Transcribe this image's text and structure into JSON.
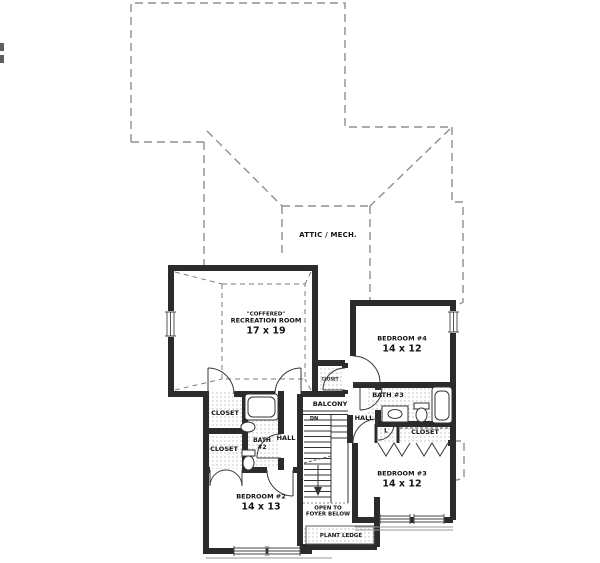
{
  "plan": {
    "type": "second-floor-plan",
    "colors": {
      "wall": "#2b2b2b",
      "roof_dash": "#8f8f8f",
      "text": "#141414",
      "bg": "#ffffff"
    },
    "rooms": {
      "attic": {
        "label": "ATTIC / MECH."
      },
      "recreation": {
        "note": "\"COFFERED\"",
        "label": "RECREATION ROOM",
        "dims": "17 x 19"
      },
      "bedroom4": {
        "label": "BEDROOM #4",
        "dims": "14 x 12"
      },
      "bath3": {
        "label": "BATH #3"
      },
      "hall_right": {
        "label": "HALL"
      },
      "linen": {
        "label": "L"
      },
      "closet_right": {
        "label": "CLOSET"
      },
      "bedroom3": {
        "label": "BEDROOM #3",
        "dims": "14 x 12"
      },
      "balcony": {
        "label": "BALCONY"
      },
      "stairs_dn": {
        "label": "DN"
      },
      "hall_left": {
        "label": "HALL"
      },
      "closet_hall": {
        "label": "CLOSET"
      },
      "closet_upper": {
        "label": "CLOSET"
      },
      "closet_lower": {
        "label": "CLOSET"
      },
      "bath2": {
        "label": "BATH",
        "number": "#2"
      },
      "bedroom2": {
        "label": "BEDROOM #2",
        "dims": "14 x 13"
      },
      "open_to_foyer": {
        "line1": "OPEN TO",
        "line2": "FOYER BELOW"
      },
      "plant_ledge": {
        "label": "PLANT LEDGE"
      }
    }
  }
}
